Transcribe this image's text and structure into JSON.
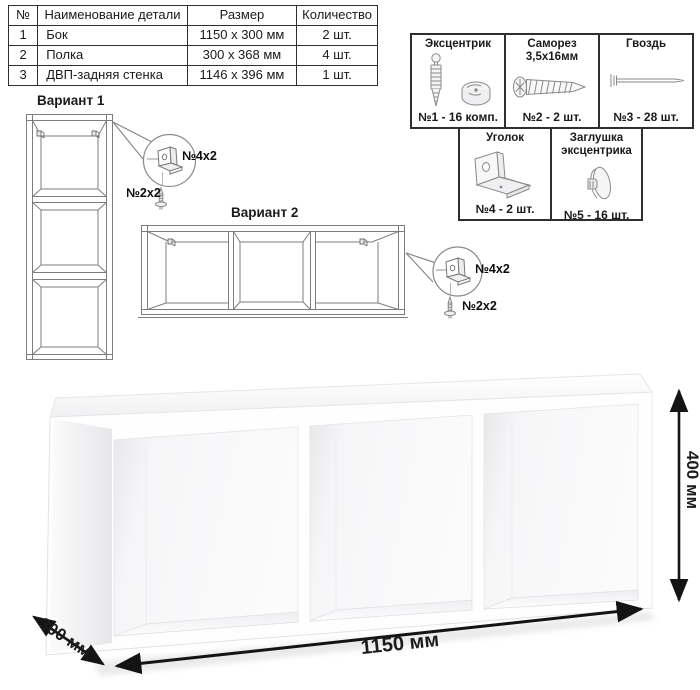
{
  "parts_table": {
    "headers": {
      "num": "№",
      "name": "Наименование детали",
      "size": "Размер",
      "qty": "Количество"
    },
    "rows": [
      {
        "num": "1",
        "name": "Бок",
        "size": "1150 x 300 мм",
        "qty": "2 шт."
      },
      {
        "num": "2",
        "name": "Полка",
        "size": "300 x 368 мм",
        "qty": "4 шт."
      },
      {
        "num": "3",
        "name": "ДВП-задняя стенка",
        "size": "1146 x 396 мм",
        "qty": "1 шт."
      }
    ]
  },
  "hardware": {
    "eccentric": {
      "title": "Эксцентрик",
      "count": "№1 - 16 комп."
    },
    "screw": {
      "title": "Саморез",
      "subtitle": "3,5х16мм",
      "count": "№2 - 2 шт."
    },
    "nail": {
      "title": "Гвоздь",
      "count": "№3 - 28 шт."
    },
    "bracket": {
      "title": "Уголок",
      "count": "№4 - 2 шт."
    },
    "cap": {
      "title": "Заглушка",
      "subtitle": "эксцентрика",
      "count": "№5 - 16 шт."
    }
  },
  "variant1": {
    "title": "Вариант 1",
    "bracket_label": "№4х2",
    "screw_label": "№2х2"
  },
  "variant2": {
    "title": "Вариант 2",
    "bracket_label": "№4х2",
    "screw_label": "№2х2"
  },
  "dimensions": {
    "width": "1150 мм",
    "height": "400 мм",
    "depth": "300 мм"
  },
  "colors": {
    "border_dark": "#2e2e2e",
    "line_gray": "#7d7d7d",
    "dim_text": "#1c1c1c"
  }
}
